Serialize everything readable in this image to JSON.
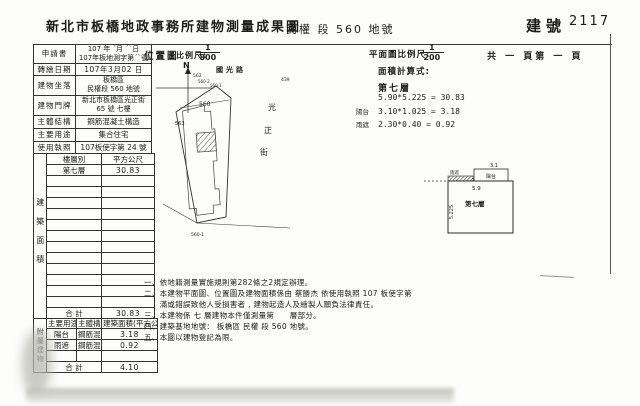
{
  "header": {
    "office_title": "新北市板橋地政事務所建物測量成果圖",
    "land_section": "民權 段 560 地號",
    "building_no_label": "建號",
    "building_no": "2117"
  },
  "info": {
    "r1_label": "申請書",
    "r1_line1": "107 年 ˊ月 ˊˋ日",
    "r1_line2": "107年板地測字第ˊˋ號",
    "r2_label": "轉繪日期",
    "r2_value": "107年3月02 日",
    "r3_label": "建物坐落",
    "r3_line1": "板橋區",
    "r3_line2": "民權段 560 地號",
    "r4_label": "建物門牌",
    "r4_line1": "新北市板橋區光正街",
    "r4_line2": "65 號 七樓",
    "r5_label": "主體結構",
    "r5_value": "鋼筋混凝土構造",
    "r6_label": "主要用途",
    "r6_value": "集合住宅",
    "r7_label": "使用執照",
    "r7_value": "107板使字第 24 號"
  },
  "area_table": {
    "side_label": "建築面積",
    "col_floor": "樓層別",
    "col_sqm": "平方公尺",
    "floor": "第七層",
    "floor_area": "30.83",
    "total_label": "合  計",
    "total": "30.83"
  },
  "annex_table": {
    "side_label": "附屬建物",
    "col_use": "主要用途",
    "col_structure": "主體構造",
    "col_area": "建築面積(平方公尺)",
    "rows": [
      {
        "use": "陽台",
        "structure": "鋼筋混凝土造",
        "area": "3.18"
      },
      {
        "use": "雨遮",
        "structure": "鋼筋混凝土造",
        "area": "0.92"
      }
    ],
    "total_label": "合  計",
    "total": "4.10"
  },
  "location_map": {
    "label": "位置圖",
    "scale_label": "比例尺:",
    "scale_num": "1",
    "scale_den": "800",
    "north": "N",
    "road_top": "國光路",
    "street_char1": "光",
    "street_char2": "正",
    "street_char3": "街",
    "parcel_main": "560",
    "parcel_left": "563",
    "parcel_top1": "562",
    "parcel_top2": "560-2",
    "parcel_top3": "560-1",
    "parcel_right": "439",
    "parcel_bottom": "560-1"
  },
  "plan": {
    "scale_label": "平面圖比例尺:",
    "scale_num": "1",
    "scale_den": "200",
    "pages": "共 一 頁第 一 頁",
    "calc_title": "面積計算式:",
    "floor_title": "第七層",
    "calc1": "5.90*5.225 = 30.83",
    "calc2_prefix": "陽台",
    "calc2": "3.10*1.025 = 3.18",
    "calc3_prefix": "雨遮",
    "calc3": "2.30*0.40 = 0.92",
    "drawing": {
      "floor_label": "第七層",
      "dim_top": "5.9",
      "dim_left": "5.225",
      "balcony": "陽台",
      "balcony_dim": "3.1",
      "canopy": "雨遮"
    }
  },
  "notes": [
    "一、依地籍測量實施規則第282條之2規定辦理。",
    "二、本建物平面圖、位置圖及建物面積係由 蔡勝杰 依使用執照 107 板使字第",
    "　　滿或錯誤致他人受損害者 , 建物起造人及繪製人願負法律責任。",
    "三、本建物係 七 層建物本件僅測量第　　層部分。",
    "四、建築基地地號： 板橋區 民權 段 560 地號。",
    "五、本圖以建物登記為限。"
  ]
}
